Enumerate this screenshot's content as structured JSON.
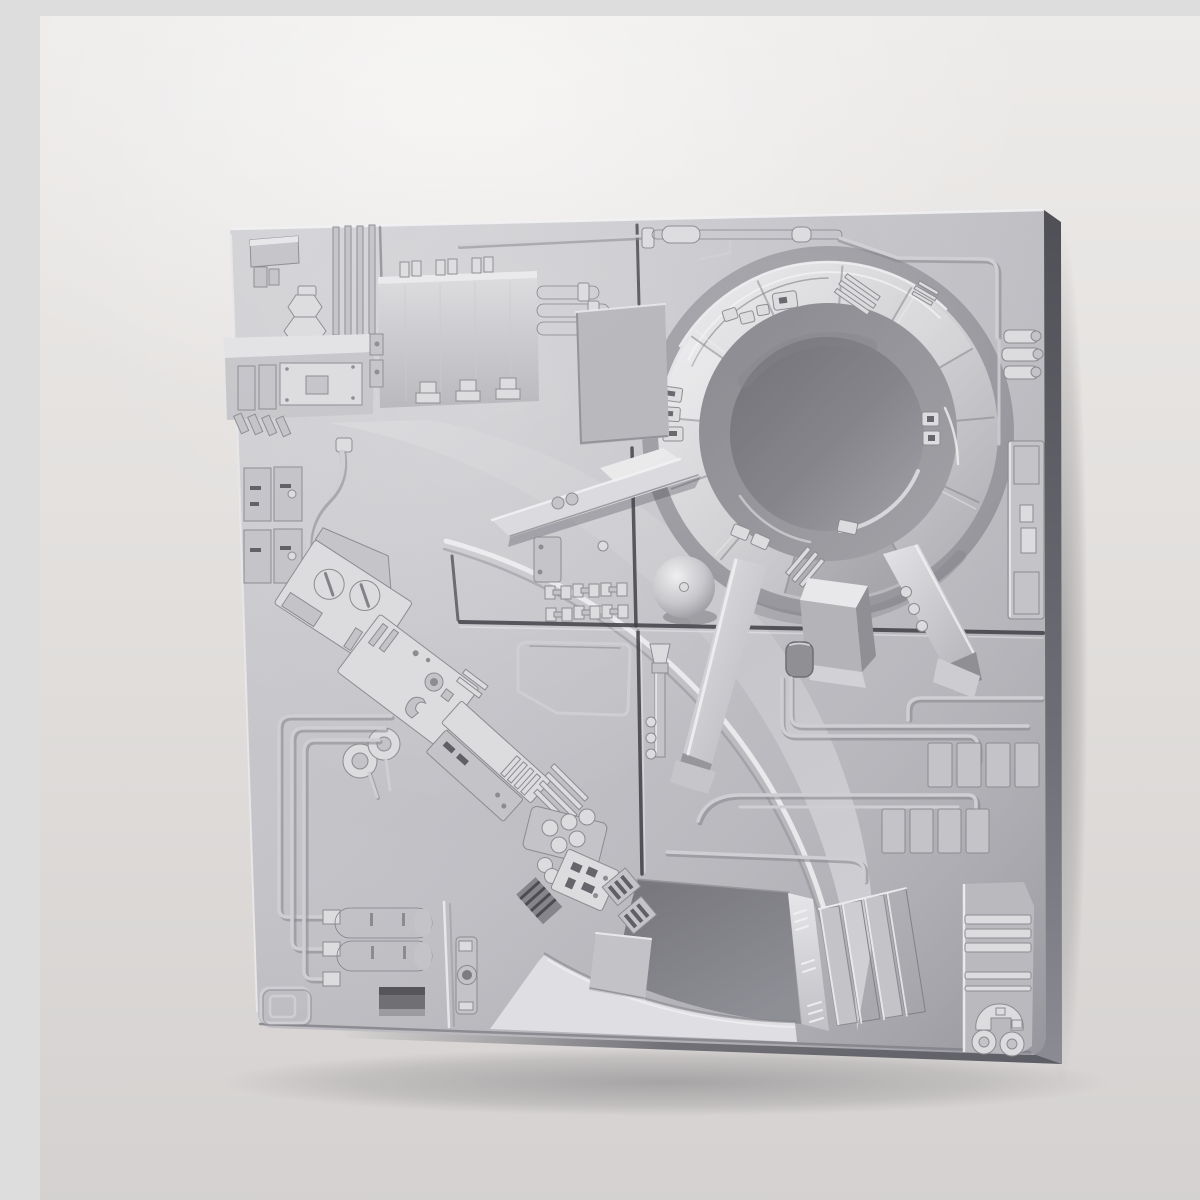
{
  "meta": {
    "alt": "Studio product photo of a square light-gray sci-fi greeble panel model: a raised circular turret ring with dark central pit and three support struts, a curved machinery trench sweeping from upper left to bottom center, ribbed equipment boxes, pipes, circuit-like raised traces, twin storage tanks and vent planks on a neutral gray backdrop"
  },
  "colors": {
    "bg_top": "#edebe9",
    "bg_bottom": "#d4d1d0",
    "plate_light": "#d0d0d4",
    "plate_mid": "#bfbfc4",
    "plate_dark": "#a7a7ad",
    "side_dark": "#4f4f56",
    "side_mid": "#7d7d84",
    "seam": "#3e3e44",
    "trace": "#cfcfd3",
    "trace_shadow": "#85858a",
    "highlight": "#f1f1f3",
    "shade": "#808086",
    "greeble_light": "#dcdcdf",
    "greeble_mid": "#c3c3c8",
    "greeble_dark": "#8b8b90",
    "ring_light": "#ededef",
    "ring_dark": "#a9a9ae",
    "pit_dark": "#6e6e74",
    "pit_light": "#a2a2a8",
    "trench_floor": "#75757b",
    "bank_light": "#d8d8db"
  },
  "scene": {
    "parts": [
      "backdrop",
      "panel-plate",
      "panel-side-edge",
      "panel-seams",
      "turret-recess",
      "turret-ring",
      "turret-pit",
      "ring-greebles",
      "support-leg-left",
      "support-foot-center",
      "support-leg-right",
      "access-blade",
      "trench-bank",
      "trench-floor",
      "trench-outer-wall",
      "trench-ramp",
      "machinery-band",
      "corner-box",
      "hex-bolt",
      "rib-strip",
      "equipment-platform",
      "switch-boxes",
      "service-cable",
      "ribbed-box",
      "feed-pipes",
      "top-pipe-run",
      "blank-square-plate",
      "pipe-stubs",
      "right-access-strip",
      "dome-bump",
      "h-connector-grid",
      "nozzle-pipe",
      "dark-knob",
      "circuit-traces",
      "vent-squares-grid",
      "vent-planks",
      "corner-stripe-unit",
      "storage-tanks",
      "recess-hatch",
      "corner-frame-outline",
      "latch-bracket",
      "cast-shadow"
    ]
  }
}
